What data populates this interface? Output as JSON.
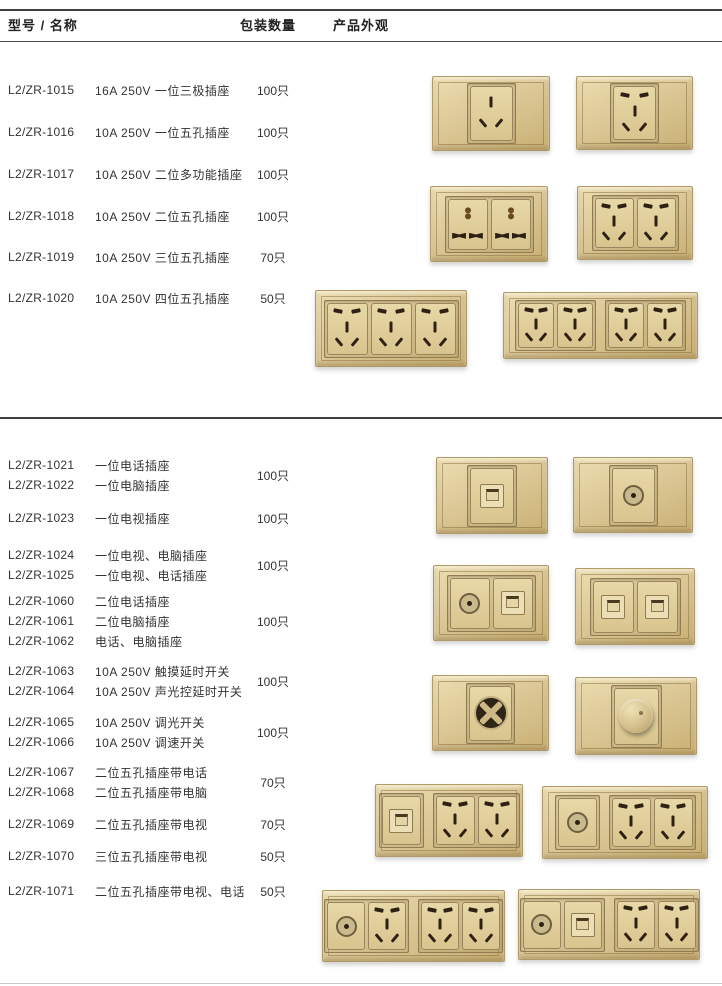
{
  "header": {
    "col_model_name": "型号 / 名称",
    "col_quantity": "包装数量",
    "col_appearance": "产品外观"
  },
  "colors": {
    "text": "#333333",
    "rule_dark": "#3f3f3f",
    "rule_light": "#c9c9c9",
    "plate_gold_light": "#ecddb0",
    "plate_gold_mid": "#dcc897",
    "plate_gold_dark": "#c9b074",
    "slot_dark": "#2e2012"
  },
  "catalog": {
    "blocks": [
      {
        "y": 80,
        "qty": "100只",
        "lines": [
          {
            "model": "L2/ZR-1015",
            "desc": "16A 250V 一位三极插座"
          }
        ]
      },
      {
        "y": 122,
        "qty": "100只",
        "lines": [
          {
            "model": "L2/ZR-1016",
            "desc": "10A 250V 一位五孔插座"
          }
        ]
      },
      {
        "y": 164,
        "qty": "100只",
        "lines": [
          {
            "model": "L2/ZR-1017",
            "desc": "10A 250V 二位多功能插座"
          }
        ]
      },
      {
        "y": 206,
        "qty": "100只",
        "lines": [
          {
            "model": "L2/ZR-1018",
            "desc": "10A 250V 二位五孔插座"
          }
        ]
      },
      {
        "y": 247,
        "qty": "70只",
        "lines": [
          {
            "model": "L2/ZR-1019",
            "desc": "10A 250V 三位五孔插座"
          }
        ]
      },
      {
        "y": 288,
        "qty": "50只",
        "lines": [
          {
            "model": "L2/ZR-1020",
            "desc": "10A 250V 四位五孔插座"
          }
        ]
      },
      {
        "y": 455,
        "qty": "100只",
        "lines": [
          {
            "model": "L2/ZR-1021",
            "desc": "一位电话插座"
          },
          {
            "model": "L2/ZR-1022",
            "desc": "一位电脑插座"
          }
        ]
      },
      {
        "y": 508,
        "qty": "100只",
        "lines": [
          {
            "model": "L2/ZR-1023",
            "desc": "一位电视插座"
          }
        ]
      },
      {
        "y": 545,
        "qty": "100只",
        "lines": [
          {
            "model": "L2/ZR-1024",
            "desc": "一位电视、电脑插座"
          },
          {
            "model": "L2/ZR-1025",
            "desc": "一位电视、电话插座"
          }
        ]
      },
      {
        "y": 591,
        "qty": "100只",
        "lines": [
          {
            "model": "L2/ZR-1060",
            "desc": "二位电话插座"
          },
          {
            "model": "L2/ZR-1061",
            "desc": "二位电脑插座"
          },
          {
            "model": "L2/ZR-1062",
            "desc": "电话、电脑插座"
          }
        ]
      },
      {
        "y": 661,
        "qty": "100只",
        "lines": [
          {
            "model": "L2/ZR-1063",
            "desc": "10A 250V 触摸延时开关"
          },
          {
            "model": "L2/ZR-1064",
            "desc": "10A 250V 声光控延时开关"
          }
        ]
      },
      {
        "y": 712,
        "qty": "100只",
        "lines": [
          {
            "model": "L2/ZR-1065",
            "desc": "10A 250V 调光开关"
          },
          {
            "model": "L2/ZR-1066",
            "desc": "10A 250V 调速开关"
          }
        ]
      },
      {
        "y": 762,
        "qty": "70只",
        "lines": [
          {
            "model": "L2/ZR-1067",
            "desc": "二位五孔插座带电话"
          },
          {
            "model": "L2/ZR-1068",
            "desc": "二位五孔插座带电脑"
          }
        ]
      },
      {
        "y": 814,
        "qty": "70只",
        "lines": [
          {
            "model": "L2/ZR-1069",
            "desc": "二位五孔插座带电视"
          }
        ]
      },
      {
        "y": 846,
        "qty": "50只",
        "lines": [
          {
            "model": "L2/ZR-1070",
            "desc": "三位五孔插座带电视"
          }
        ]
      },
      {
        "y": 881,
        "qty": "50只",
        "lines": [
          {
            "model": "L2/ZR-1071",
            "desc": "二位五孔插座带电视、电话"
          }
        ]
      }
    ]
  },
  "products": [
    {
      "name": "socket-1gang-3pin",
      "x": 432,
      "y": 76,
      "w": 116,
      "h": 73,
      "groups": [
        [
          "3pin"
        ]
      ]
    },
    {
      "name": "socket-1gang-5hole",
      "x": 576,
      "y": 76,
      "w": 115,
      "h": 72,
      "groups": [
        [
          "5hole"
        ]
      ]
    },
    {
      "name": "socket-2gang-universal",
      "x": 430,
      "y": 186,
      "w": 116,
      "h": 74,
      "groups": [
        [
          "multi",
          "multi"
        ]
      ]
    },
    {
      "name": "socket-2gang-5hole",
      "x": 577,
      "y": 186,
      "w": 114,
      "h": 72,
      "groups": [
        [
          "5hole",
          "5hole"
        ]
      ]
    },
    {
      "name": "socket-3gang-5hole",
      "x": 315,
      "y": 290,
      "w": 150,
      "h": 75,
      "groups": [
        [
          "5hole",
          "5hole",
          "5hole"
        ]
      ]
    },
    {
      "name": "socket-4gang-5hole",
      "x": 503,
      "y": 292,
      "w": 193,
      "h": 65,
      "groups": [
        [
          "5hole",
          "5hole"
        ],
        [
          "5hole",
          "5hole"
        ]
      ]
    },
    {
      "name": "socket-phone",
      "x": 436,
      "y": 457,
      "w": 110,
      "h": 75,
      "groups": [
        [
          "phone"
        ]
      ]
    },
    {
      "name": "socket-tv",
      "x": 573,
      "y": 457,
      "w": 118,
      "h": 74,
      "groups": [
        [
          "tv"
        ]
      ]
    },
    {
      "name": "socket-tv-plus-jack",
      "x": 433,
      "y": 565,
      "w": 114,
      "h": 74,
      "groups": [
        [
          "tv",
          "phone"
        ]
      ]
    },
    {
      "name": "socket-double-jack",
      "x": 575,
      "y": 568,
      "w": 118,
      "h": 75,
      "groups": [
        [
          "phone",
          "phone"
        ]
      ]
    },
    {
      "name": "switch-touch-delay",
      "x": 432,
      "y": 675,
      "w": 115,
      "h": 74,
      "groups": [
        [
          "touch"
        ]
      ]
    },
    {
      "name": "switch-rotary-dimmer",
      "x": 575,
      "y": 677,
      "w": 120,
      "h": 76,
      "groups": [
        [
          "dimmer"
        ]
      ]
    },
    {
      "name": "socket-phone-2x5hole",
      "x": 375,
      "y": 784,
      "w": 146,
      "h": 71,
      "groups": [
        [
          "phone"
        ],
        [
          "5hole",
          "5hole"
        ]
      ]
    },
    {
      "name": "socket-tv-2x5hole",
      "x": 542,
      "y": 786,
      "w": 164,
      "h": 71,
      "groups": [
        [
          "tv"
        ],
        [
          "5hole",
          "5hole"
        ]
      ]
    },
    {
      "name": "socket-tv-3x5hole",
      "x": 322,
      "y": 890,
      "w": 181,
      "h": 70,
      "groups": [
        [
          "tv",
          "5hole"
        ],
        [
          "5hole",
          "5hole"
        ]
      ]
    },
    {
      "name": "socket-tv-phone-2x5hole",
      "x": 518,
      "y": 889,
      "w": 180,
      "h": 69,
      "groups": [
        [
          "tv",
          "phone"
        ],
        [
          "5hole",
          "5hole"
        ]
      ]
    }
  ]
}
